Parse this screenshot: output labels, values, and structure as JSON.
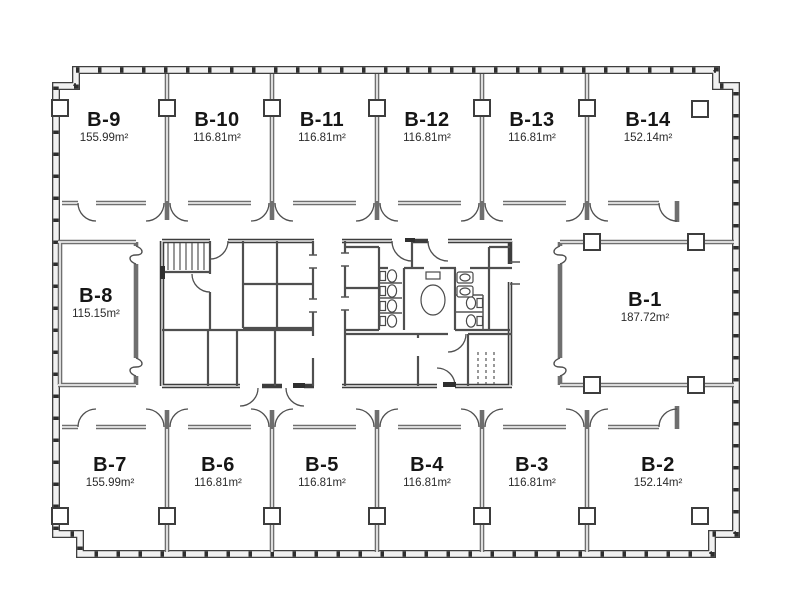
{
  "rooms": [
    {
      "name": "B-9",
      "area": "155.99m²"
    },
    {
      "name": "B-10",
      "area": "116.81m²"
    },
    {
      "name": "B-11",
      "area": "116.81m²"
    },
    {
      "name": "B-12",
      "area": "116.81m²"
    },
    {
      "name": "B-13",
      "area": "116.81m²"
    },
    {
      "name": "B-14",
      "area": "152.14m²"
    },
    {
      "name": "B-8",
      "area": "115.15m²"
    },
    {
      "name": "B-1",
      "area": "187.72m²"
    },
    {
      "name": "B-7",
      "area": "155.99m²"
    },
    {
      "name": "B-6",
      "area": "116.81m²"
    },
    {
      "name": "B-5",
      "area": "116.81m²"
    },
    {
      "name": "B-4",
      "area": "116.81m²"
    },
    {
      "name": "B-3",
      "area": "116.81m²"
    },
    {
      "name": "B-2",
      "area": "152.14m²"
    }
  ]
}
